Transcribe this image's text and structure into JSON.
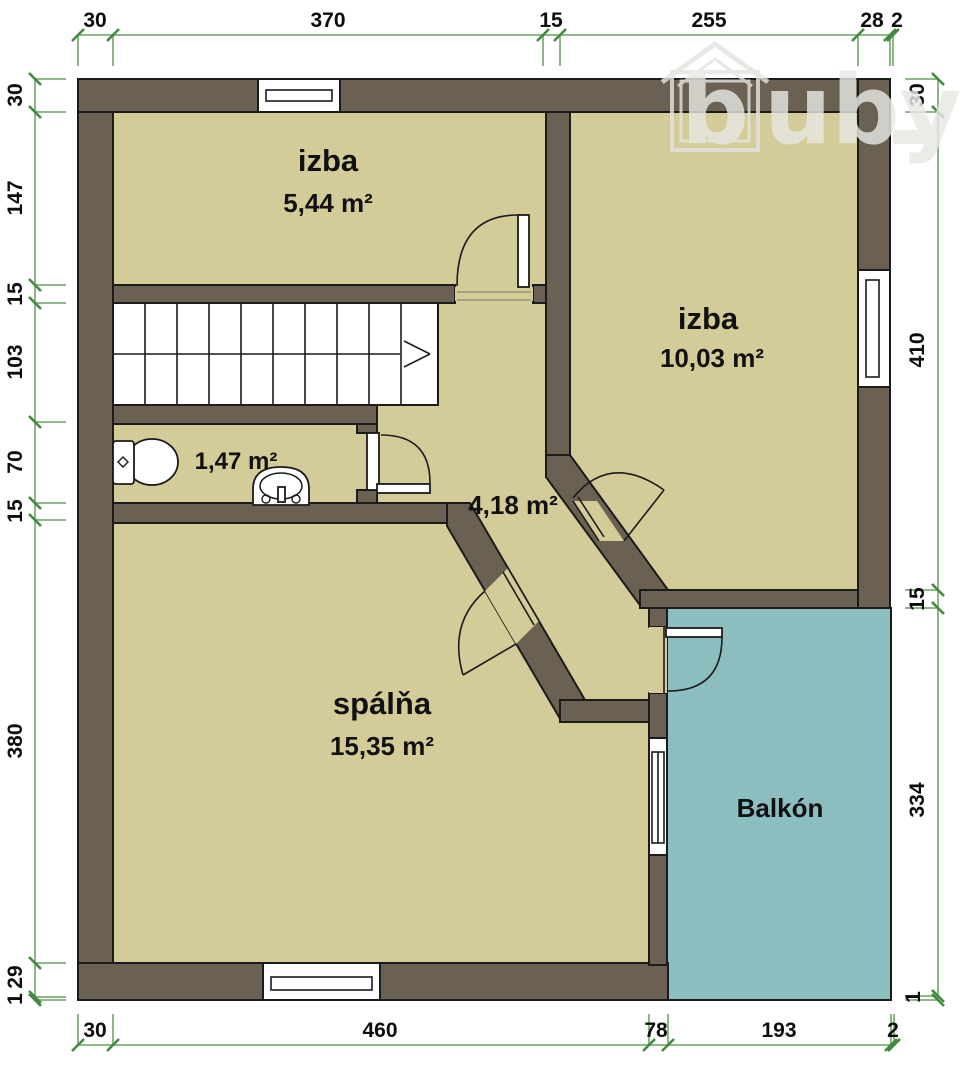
{
  "plan": {
    "title": "floor-plan",
    "rooms": [
      {
        "id": "izba-small",
        "name": "izba",
        "area": "5,44 m²"
      },
      {
        "id": "izba-large",
        "name": "izba",
        "area": "10,03 m²"
      },
      {
        "id": "bathroom",
        "name": "",
        "area": "1,47 m²"
      },
      {
        "id": "hallway",
        "name": "",
        "area": "4,18 m²"
      },
      {
        "id": "bedroom",
        "name": "spálňa",
        "area": "15,35 m²"
      },
      {
        "id": "balcony",
        "name": "Balkón",
        "area": ""
      }
    ],
    "dimensions": {
      "top": [
        "30",
        "370",
        "15",
        "255",
        "28",
        "2"
      ],
      "left": [
        "30",
        "147",
        "15",
        "103",
        "70",
        "15",
        "380",
        "29",
        "1"
      ],
      "right": [
        "30",
        "410",
        "15",
        "334",
        "1"
      ],
      "bottom": [
        "30",
        "460",
        "78",
        "193",
        "2"
      ]
    },
    "watermark": {
      "text": "buby",
      "first": "b",
      "rest": "uby"
    },
    "colors": {
      "wall": "#6a6153",
      "floor": "#d3cc99",
      "balcony": "#8cbdbf",
      "dimension_line": "#7fae76",
      "dimension_tick": "#3e8c3c"
    }
  }
}
